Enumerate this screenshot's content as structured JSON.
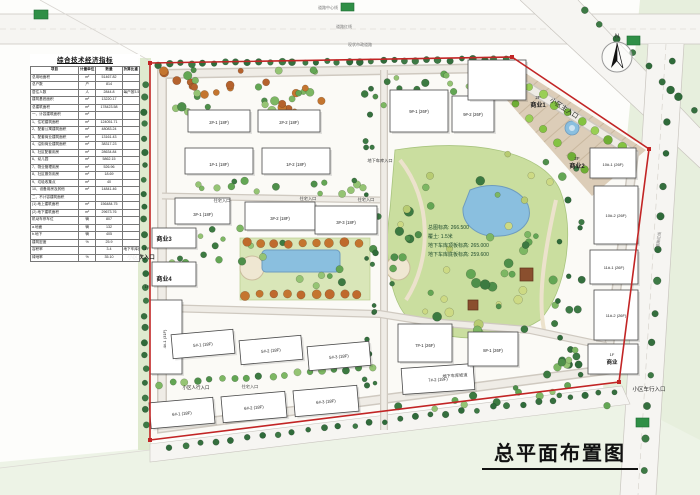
{
  "page_title": "总平面布置图",
  "table": {
    "title": "综合技术经济指标",
    "headers": [
      "项目",
      "计量单位",
      "数量",
      "折算比重"
    ],
    "rows": [
      [
        "总用地面积",
        "m²",
        "51467.82",
        ""
      ],
      [
        "总户数",
        "户",
        "814",
        ""
      ],
      [
        "居住人数",
        "人",
        "2844.8",
        "每户按3.5人计算"
      ],
      [
        "建筑基底面积",
        "m²",
        "13220.17",
        ""
      ],
      [
        "总建筑面积",
        "m²",
        "178423.58",
        ""
      ],
      [
        "一、计容建筑面积",
        "m²",
        "",
        ""
      ],
      [
        "1、住宅建筑面积",
        "m²",
        "124051.71",
        ""
      ],
      [
        "2、配套公寓建筑面积",
        "m²",
        "48083.24",
        ""
      ],
      [
        "3、配套商业建筑面积",
        "m²",
        "13161.43",
        ""
      ],
      [
        "4、沿街商业建筑面积",
        "m²",
        "38317.23",
        ""
      ],
      [
        "5、社区配套用房",
        "m²",
        "28634.84",
        ""
      ],
      [
        "6、幼儿园",
        "m²",
        "5862.15",
        ""
      ],
      [
        "7、物业管理用房",
        "m²",
        "526.96",
        ""
      ],
      [
        "8、社区服务用房",
        "m²",
        "18.69",
        ""
      ],
      [
        "9、垃圾收集点",
        "m²",
        "40",
        ""
      ],
      [
        "10、设备用房及其他",
        "m²",
        "14841.46",
        ""
      ],
      [
        "二、不计容建筑面积",
        "",
        "",
        ""
      ],
      [
        "(1) 地上建筑面积",
        "m²",
        "156484.75",
        ""
      ],
      [
        "(2) 地下建筑面积",
        "m²",
        "29673.76",
        ""
      ],
      [
        "机动车停车位",
        "辆",
        "807",
        ""
      ],
      [
        "a.地面",
        "辆",
        "132",
        ""
      ],
      [
        "b.地下",
        "辆",
        "405",
        ""
      ],
      [
        "建筑密度",
        "%",
        "25.9",
        ""
      ],
      [
        "容积率",
        "",
        "3.4",
        "地下车库面积折半计算"
      ],
      [
        "绿地率",
        "%",
        "35.10",
        ""
      ]
    ]
  },
  "elevation_notes": {
    "lines": [
      "总图标高: 266.500",
      "覆土: 1.5米",
      "地下车库顶板标高: 265.000",
      "地下车库底板标高: 259.600"
    ]
  },
  "map": {
    "labels": [
      {
        "n": "label-shangye1-floor",
        "t": "2F",
        "x": 538,
        "y": 99,
        "s": 4.5
      },
      {
        "n": "label-shangye1",
        "t": "商业1",
        "x": 538,
        "y": 107,
        "s": 6,
        "w": 1
      },
      {
        "n": "label-shangye2-floor",
        "t": "2F",
        "x": 577,
        "y": 160,
        "s": 4.5
      },
      {
        "n": "label-shangye2",
        "t": "商业2",
        "x": 577,
        "y": 168,
        "s": 6,
        "w": 1
      },
      {
        "n": "label-shangye3",
        "t": "商业3",
        "x": 164,
        "y": 241,
        "s": 6,
        "w": 1
      },
      {
        "n": "label-shangye3-floor",
        "t": "1F",
        "x": 147,
        "y": 250,
        "s": 4
      },
      {
        "n": "label-shangye4",
        "t": "商业4",
        "x": 164,
        "y": 281,
        "s": 6,
        "w": 1
      },
      {
        "n": "label-shangye4-floor",
        "t": "1F",
        "x": 147,
        "y": 288,
        "s": 4
      },
      {
        "n": "label-shangye5-floor",
        "t": "1F",
        "x": 612,
        "y": 356,
        "s": 4
      },
      {
        "n": "label-shangye5",
        "t": "商业",
        "x": 612,
        "y": 364,
        "s": 5.5,
        "w": 1
      },
      {
        "n": "label-main-entrance",
        "t": "小区主入口",
        "x": 563,
        "y": 110,
        "s": 6.5,
        "r": 33
      },
      {
        "n": "label-secondary-entrance",
        "t": "小区次入口",
        "x": 141,
        "y": 259,
        "s": 5.5,
        "w": 1
      },
      {
        "n": "label-vehicle-entrance",
        "t": "小区车行入口",
        "x": 649,
        "y": 391,
        "s": 5.5
      },
      {
        "n": "label-pedestrian-entrance",
        "t": "小区人行入口",
        "x": 196,
        "y": 389,
        "s": 4.5
      },
      {
        "n": "label-residence-entrance-1",
        "t": "住宅入口",
        "x": 250,
        "y": 388,
        "s": 4.2,
        "c": "#444"
      },
      {
        "n": "label-residence-entrance-2",
        "t": "住宅入口",
        "x": 222,
        "y": 202,
        "s": 4.2,
        "c": "#444"
      },
      {
        "n": "label-residence-entrance-3",
        "t": "住宅入口",
        "x": 308,
        "y": 200,
        "s": 4.2,
        "c": "#444"
      },
      {
        "n": "label-residence-entrance-4",
        "t": "住宅入口",
        "x": 366,
        "y": 201,
        "s": 4.2,
        "c": "#444"
      },
      {
        "n": "label-garage-entrance",
        "t": "地下车库入口",
        "x": 380,
        "y": 162,
        "s": 4.2,
        "c": "#333"
      },
      {
        "n": "label-garage-ramp",
        "t": "地下车库坡道",
        "x": 455,
        "y": 377,
        "s": 4.2,
        "r": -3,
        "c": "#333"
      },
      {
        "n": "label-building-1-1",
        "t": "1#-1 (18F)",
        "x": 219,
        "y": 166,
        "s": 4.2
      },
      {
        "n": "label-building-1-2",
        "t": "1#-2 (18F)",
        "x": 296,
        "y": 166,
        "s": 4.2
      },
      {
        "n": "label-building-2-1",
        "t": "2#-1 (18F)",
        "x": 219,
        "y": 124,
        "s": 4.2
      },
      {
        "n": "label-building-2-2",
        "t": "2#-2 (18F)",
        "x": 289,
        "y": 124,
        "s": 4.2
      },
      {
        "n": "label-building-3-1",
        "t": "3#-1 (18F)",
        "x": 203,
        "y": 216,
        "s": 4.2
      },
      {
        "n": "label-building-3-2",
        "t": "3#-2 (18F)",
        "x": 280,
        "y": 220,
        "s": 4.2
      },
      {
        "n": "label-building-3-3",
        "t": "3#-3 (18F)",
        "x": 346,
        "y": 224,
        "s": 4.2
      },
      {
        "n": "label-building-4-1",
        "t": "4#-1 (31F)",
        "x": 166,
        "y": 339,
        "s": 4,
        "r": -90
      },
      {
        "n": "label-building-5-1",
        "t": "5#-1 (18F)",
        "x": 203,
        "y": 346,
        "s": 4.2,
        "r": -5
      },
      {
        "n": "label-building-5-2",
        "t": "5#-2 (18F)",
        "x": 271,
        "y": 352,
        "s": 4.2,
        "r": -5
      },
      {
        "n": "label-building-5-3",
        "t": "5#-3 (18F)",
        "x": 339,
        "y": 358,
        "s": 4.2,
        "r": -5
      },
      {
        "n": "label-building-6-1",
        "t": "6#-1 (18F)",
        "x": 182,
        "y": 415,
        "s": 4.2,
        "r": -5
      },
      {
        "n": "label-building-6-2",
        "t": "6#-2 (18F)",
        "x": 254,
        "y": 409,
        "s": 4.2,
        "r": -5
      },
      {
        "n": "label-building-6-3",
        "t": "6#-3 (18F)",
        "x": 326,
        "y": 403,
        "s": 4.2,
        "r": -5
      },
      {
        "n": "label-building-7-1",
        "t": "7#-1 (26F)",
        "x": 425,
        "y": 347,
        "s": 4.2
      },
      {
        "n": "label-building-7-2",
        "t": "7#-2 (18F)",
        "x": 438,
        "y": 381,
        "s": 4.2,
        "r": -4
      },
      {
        "n": "label-building-8-1",
        "t": "8#-1 (26F)",
        "x": 493,
        "y": 352,
        "s": 4.2
      },
      {
        "n": "label-building-9-1",
        "t": "9#-1 (26F)",
        "x": 419,
        "y": 113,
        "s": 4.2
      },
      {
        "n": "label-building-9-2",
        "t": "9#-2 (26F)",
        "x": 473,
        "y": 116,
        "s": 4.2
      },
      {
        "n": "label-building-10-1",
        "t": "10#-1 (26F)",
        "x": 613,
        "y": 166,
        "s": 4
      },
      {
        "n": "label-building-10-2",
        "t": "10#-2 (26F)",
        "x": 616,
        "y": 217,
        "s": 4
      },
      {
        "n": "label-building-11-1",
        "t": "11#-1 (26F)",
        "x": 614,
        "y": 269,
        "s": 4
      },
      {
        "n": "label-building-11-2",
        "t": "11#-2 (26F)",
        "x": 616,
        "y": 317,
        "s": 4
      },
      {
        "n": "label-north",
        "t": "N",
        "x": 617,
        "y": 38,
        "s": 6,
        "c": "#333"
      },
      {
        "n": "label-road-centerline",
        "t": "道路中心线",
        "x": 318,
        "y": 9,
        "s": 4,
        "a": "start",
        "c": "#777"
      },
      {
        "n": "label-road-redline",
        "t": "道路红线",
        "x": 336,
        "y": 28,
        "s": 4,
        "a": "start",
        "c": "#777"
      },
      {
        "n": "label-existing-road",
        "t": "现状市政道路",
        "x": 348,
        "y": 46,
        "s": 4,
        "a": "start",
        "c": "#777"
      },
      {
        "n": "label-road-redline-right",
        "t": "道路红线",
        "x": 660,
        "y": 240,
        "s": 4,
        "r": -83,
        "c": "#777"
      }
    ]
  },
  "colors": {
    "boundary_red": "#c22525",
    "water": "#8abfdf",
    "plaza": "#dccdb8",
    "park_green": "#cade9f",
    "stamp_green": "#2f8f46",
    "accent_tree": "#b5622d"
  }
}
